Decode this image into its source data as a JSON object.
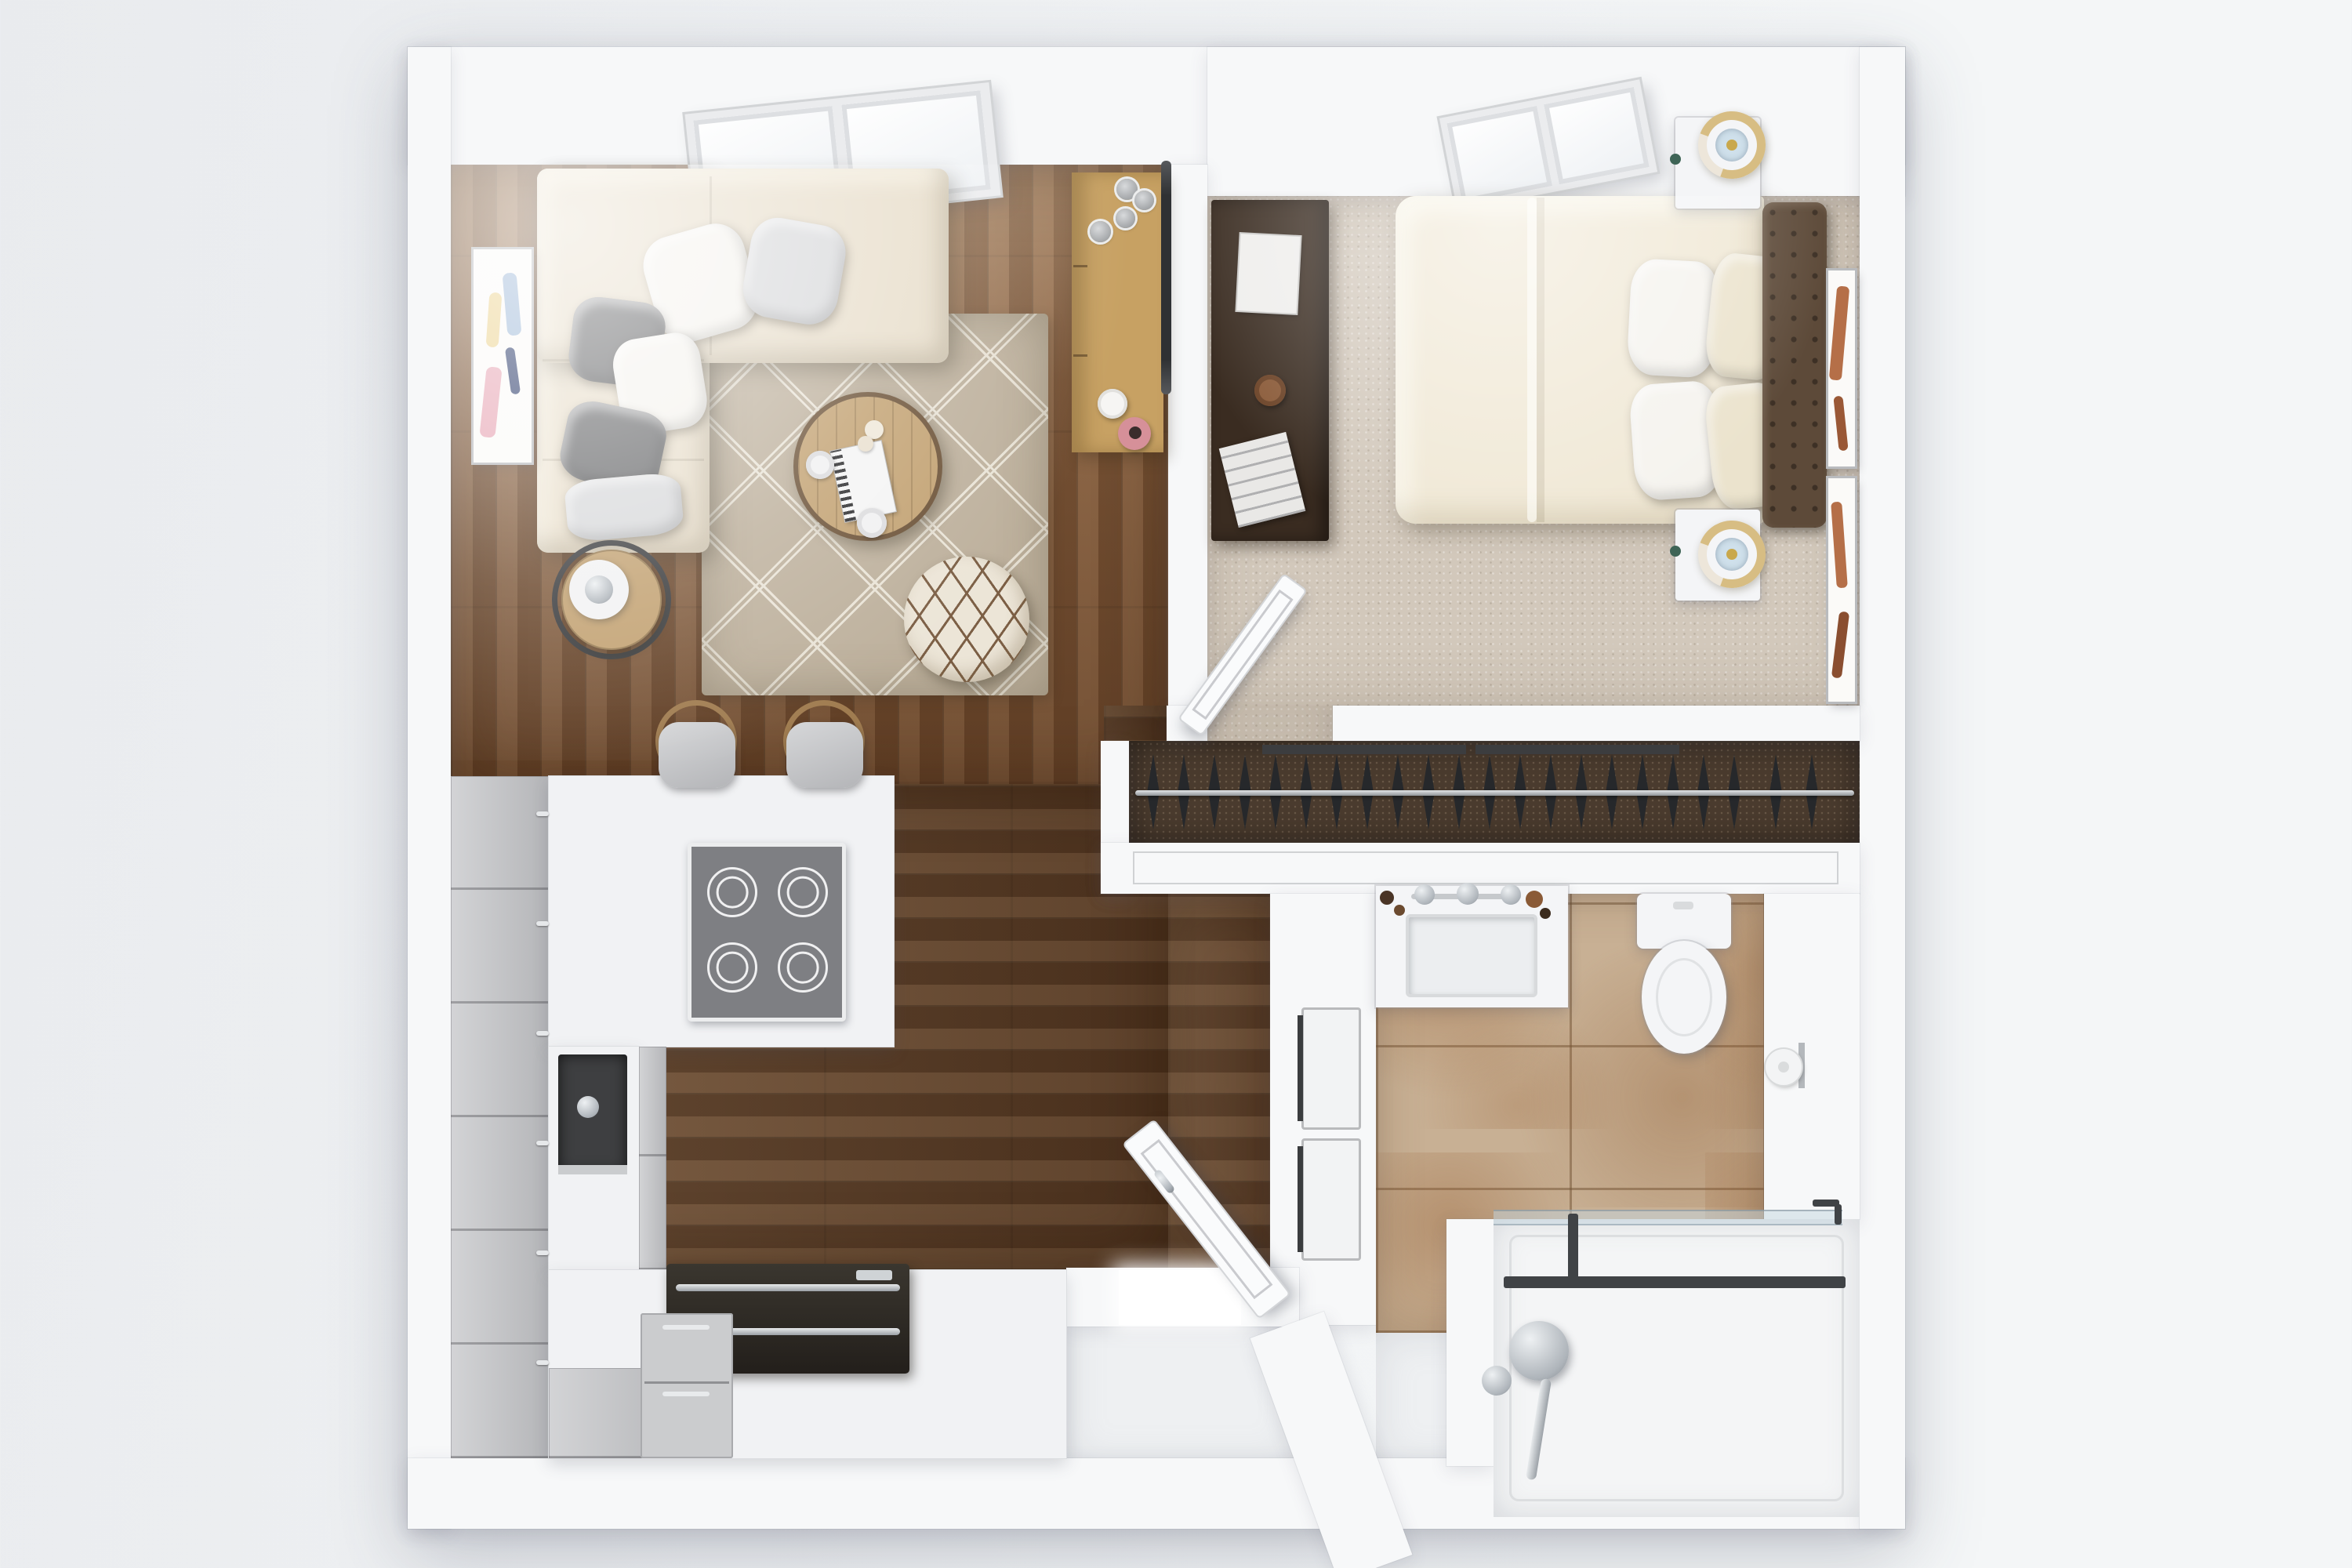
{
  "scene": {
    "description": "photorealistic 3d-rendered top-down floor plan of a one-bedroom apartment",
    "rooms": [
      {
        "name": "living-room",
        "floor": "hardwood",
        "furniture": [
          "sectional-sofa",
          "throw-pillows",
          "area-rug",
          "round-coffee-table",
          "floor-pouf",
          "side-table-with-lamp",
          "media-console",
          "decor-pots",
          "white-vase",
          "pink-vase",
          "wall-art",
          "skylight"
        ]
      },
      {
        "name": "kitchen",
        "floor": "hardwood",
        "furniture": [
          "gray-tall-cabinets",
          "white-counters",
          "cooktop",
          "dark-sink",
          "range-oven",
          "dishwasher",
          "bar-stools"
        ]
      },
      {
        "name": "bedroom",
        "floor": "carpet",
        "furniture": [
          "double-bed",
          "duvet",
          "bed-pillows",
          "tufted-headboard",
          "nightstand-top",
          "nightstand-bottom",
          "gold-lamps",
          "desk",
          "books",
          "coffee-cup",
          "wall-art-frames",
          "skylight",
          "open-door"
        ]
      },
      {
        "name": "closet",
        "floor": "dark-carpet",
        "furniture": [
          "clothes-rod",
          "hangers",
          "sliding-door-tracks"
        ]
      },
      {
        "name": "bathroom",
        "floor": "stone-tile",
        "furniture": [
          "vanity-with-sink",
          "faucet",
          "toilet",
          "toilet-paper-holder",
          "walk-in-shower",
          "shower-glass-door",
          "shower-valve"
        ]
      },
      {
        "name": "entry-hall",
        "floor": "white",
        "furniture": [
          "open-front-door",
          "washer-dryer-closet"
        ]
      }
    ],
    "counts": {
      "closet_hangers": 22,
      "cooktop_burners": 4,
      "bar_stools": 2,
      "sofa_pillows": 6,
      "bed_pillows": 4,
      "cabinet_handles": 6,
      "skylights": 2
    },
    "palette": {
      "bg1": "#e9ebee",
      "bg2": "#f4f6f7",
      "wall": "#f7f8f9",
      "counterEdge": "#dcdee1",
      "wood": "#7c5333",
      "woodDark": "#5f4028",
      "carpet": "#d2c8bb",
      "closetCarpet": "#4a3b2e",
      "tile": "#c8b094",
      "whiteFloor": "#eef0f2",
      "counter": "#f1f2f4",
      "cabinet": "#c4c5c8",
      "fixWhite": "#f4f5f7",
      "door": "#fafbfc",
      "sofa": "#e8decb",
      "rug": "#bdb09c",
      "rugLine": "#e9e3d6",
      "pillowWhite": "#f5f3ee",
      "pillowGray": "#6a6b6d",
      "pillowLight": "#d8d9db",
      "pillowCream": "#ebe3cd",
      "tableWood": "#c2a171",
      "pouf": "#ece5d7",
      "poufLine": "#7c5f45",
      "console": "#c7a163",
      "duvet": "#f0e8d5",
      "headboard": "#5d4a39",
      "desk": "#3a2c21",
      "dark": "#2d2f32",
      "rail": "#404346",
      "chrome": "#aeb4ba",
      "steel": "#9aa0a6",
      "lampGold": "#d7bd83",
      "lampBlue": "#cfe0eb",
      "hanger": "#26282b",
      "artPink": "#e8a9b7",
      "artBlue": "#9fb9d8",
      "artYellow": "#ecd391",
      "artNavy": "#31406e",
      "artRust": "#b56f48"
    }
  }
}
